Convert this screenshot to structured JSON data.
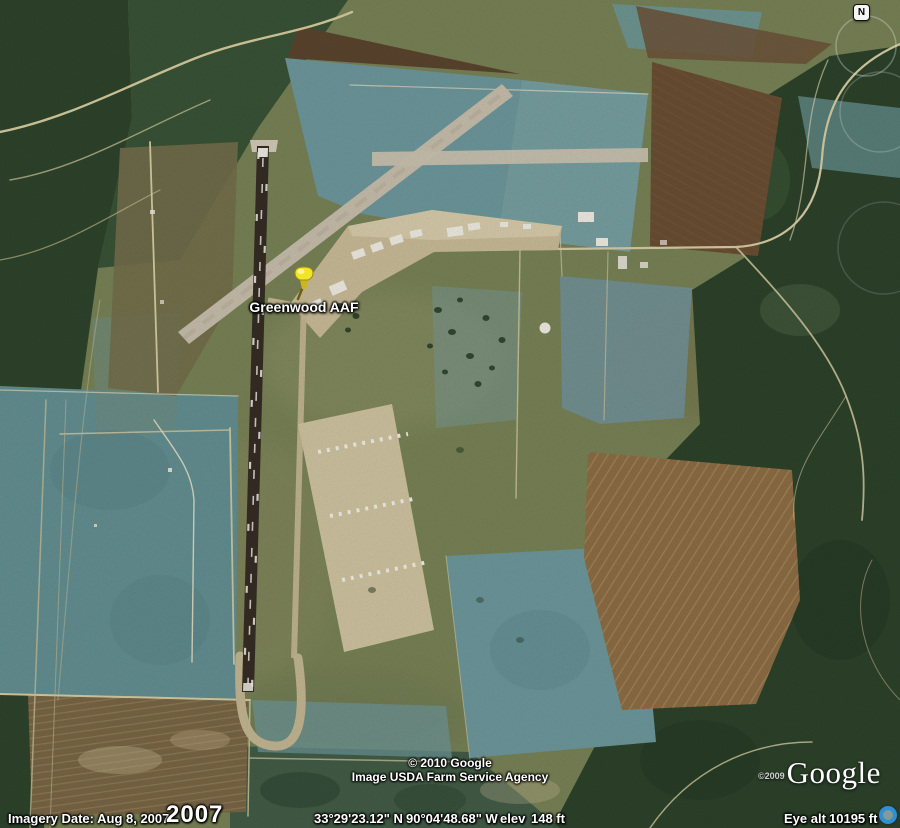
{
  "map": {
    "placemark": {
      "label": "Greenwood AAF",
      "pin_color": "#f2e428"
    },
    "compass": {
      "label": "N"
    },
    "palette": {
      "field_teal": "#6f9a9e",
      "field_olive": "#7a8457",
      "field_brown": "#6b4f33",
      "field_gold": "#8f6f46",
      "forest_dark": "#2d432b",
      "runway_dark": "#372e25",
      "pavement_tan": "#ccbe9a",
      "accent_blue": "#2f8fd4"
    }
  },
  "attribution": {
    "line1": "© 2010 Google",
    "line2": "Image USDA Farm Service Agency",
    "logo": "Google",
    "logo_year": "©2009"
  },
  "status_bar": {
    "imagery_date": "Imagery Date: Aug 8, 2007",
    "year": "2007",
    "latitude": "33°29'23.12\" N",
    "longitude": "90°04'48.68\" W",
    "elev_label": "elev",
    "elevation": "148 ft",
    "eye_alt_label": "Eye alt",
    "eye_altitude": "10195 ft"
  }
}
